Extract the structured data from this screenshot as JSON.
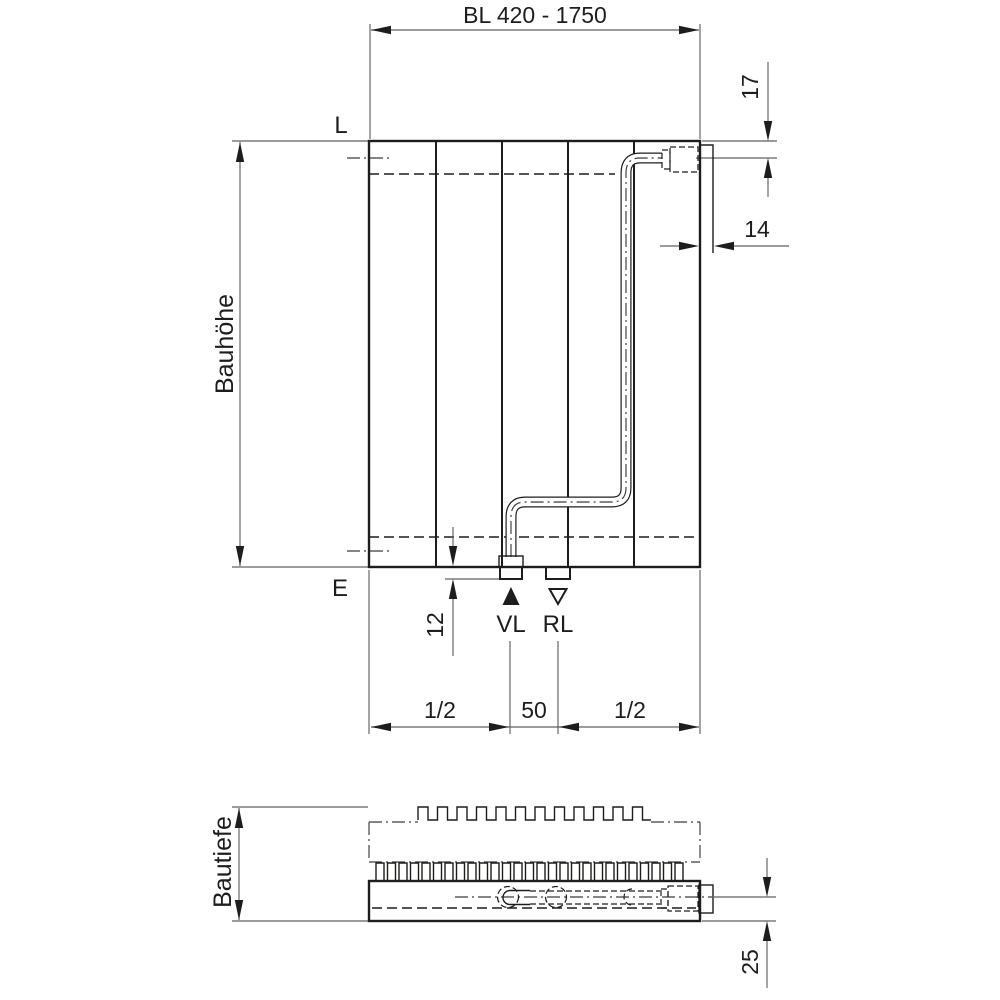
{
  "front_view": {
    "width_dim_label": "BL 420 - 1750",
    "height_dim_label": "Bauhöhe",
    "top_level_label": "L",
    "bottom_level_label": "E",
    "dim_top_connection_offset": "17",
    "dim_side_tab_width": "14",
    "dim_bottom_stub_height": "12",
    "dim_center_spacing": "50",
    "dim_half_left": "1/2",
    "dim_half_right": "1/2",
    "supply_label": "VL",
    "return_label": "RL"
  },
  "bottom_view": {
    "depth_dim_label": "Bautiefe",
    "dim_connection_depth": "25"
  },
  "colors": {
    "line": "#1d1d1b",
    "thin_line": "#606060",
    "background": "#ffffff"
  }
}
